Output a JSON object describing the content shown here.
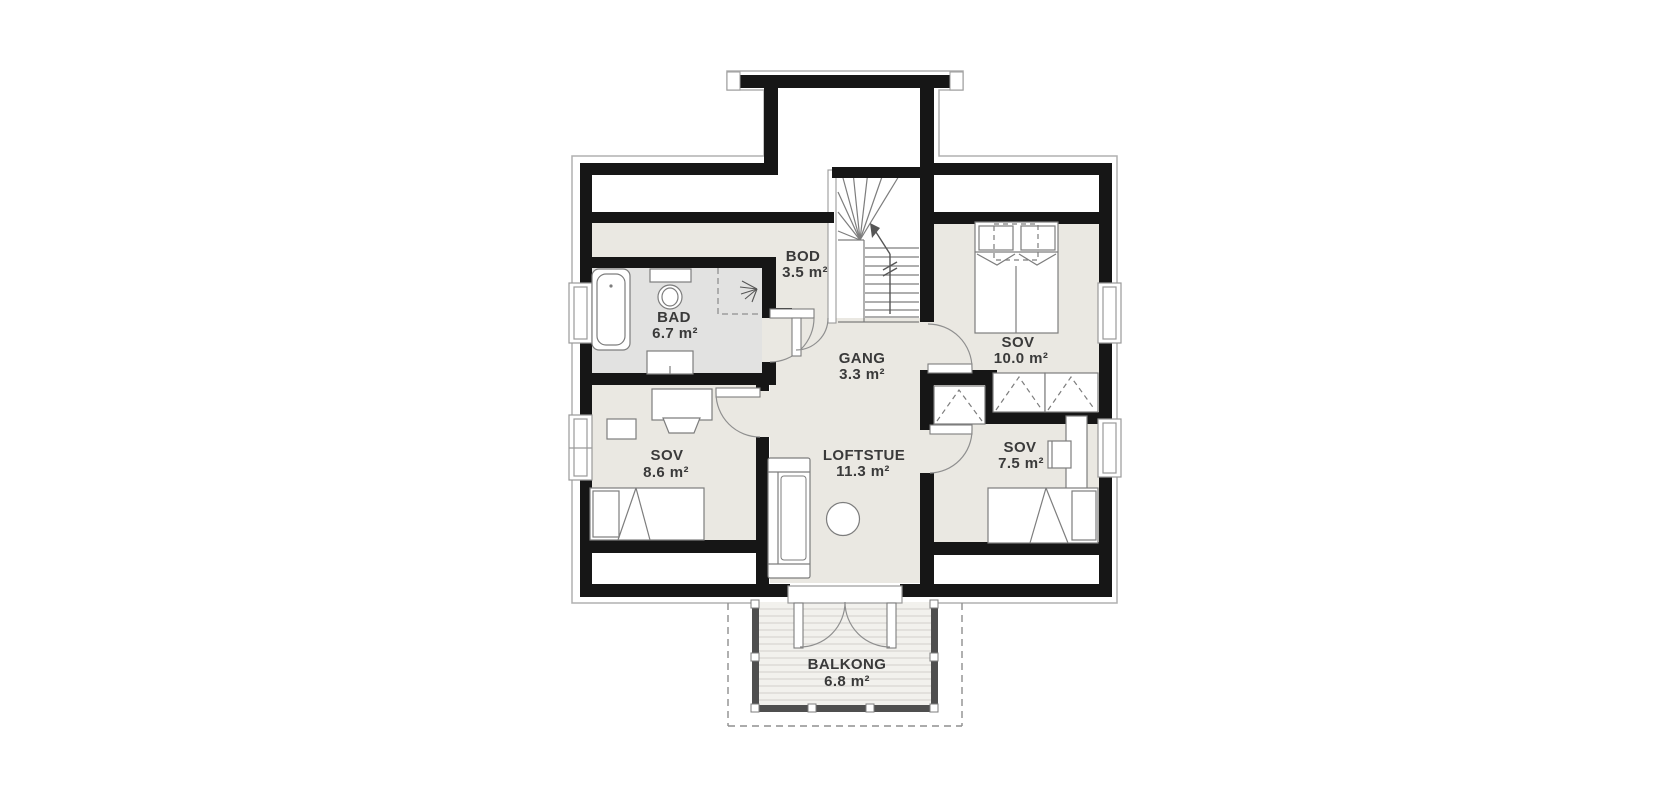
{
  "title": "floor-plan-upper-storey",
  "palette": {
    "background": "#ffffff",
    "wall": "#161616",
    "room_fill": "#eae8e2",
    "bath_fill": "#e2e2e1",
    "eaves_outline": "#b0b0b0",
    "furniture_stroke": "#7d7d7d",
    "door_arc": "#8f8f8f",
    "deck_rail": "#4f4f4f",
    "deck_fill": "#f2f1ed",
    "deck_stripe": "#dcdbd7",
    "dashed_line": "#8f8f8f",
    "text": "#3a3a3a"
  },
  "icons": {
    "stair_direction_arrow": "arrow-up-left",
    "shower_head": "spray-fan"
  },
  "rooms": [
    {
      "id": "bod",
      "name": "BOD",
      "area": "3.5 m²"
    },
    {
      "id": "bad",
      "name": "BAD",
      "area": "6.7 m²"
    },
    {
      "id": "gang",
      "name": "GANG",
      "area": "3.3 m²"
    },
    {
      "id": "sov-10",
      "name": "SOV",
      "area": "10.0 m²"
    },
    {
      "id": "sov-8-6",
      "name": "SOV",
      "area": "8.6 m²"
    },
    {
      "id": "loftstue",
      "name": "LOFTSTUE",
      "area": "11.3 m²"
    },
    {
      "id": "sov-7-5",
      "name": "SOV",
      "area": "7.5 m²"
    },
    {
      "id": "balkong",
      "name": "BALKONG",
      "area": "6.8 m²"
    }
  ]
}
